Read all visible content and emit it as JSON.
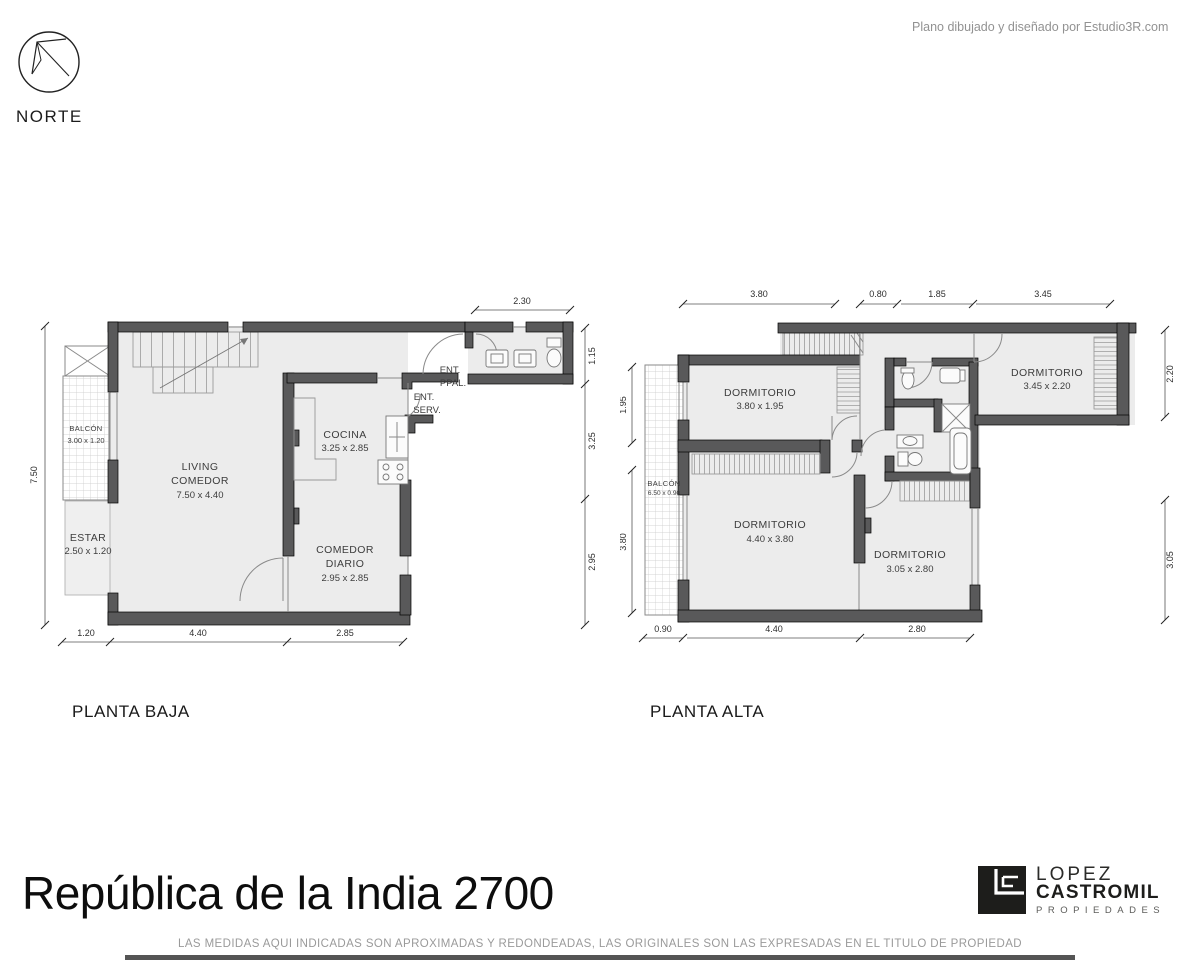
{
  "meta": {
    "credit": "Plano dibujado y diseñado por Estudio3R.com",
    "north_label": "NORTE",
    "title": "República de la India 2700",
    "disclaimer": "LAS MEDIDAS AQUI INDICADAS SON APROXIMADAS Y REDONDEADAS, LAS ORIGINALES SON LAS EXPRESADAS EN EL TITULO DE PROPIEDAD"
  },
  "branding": {
    "monogram": "LC",
    "line1": "LOPEZ",
    "line2": "CASTROMIL",
    "line3": "PROPIEDADES",
    "logo_color": "#1d1d1b"
  },
  "colors": {
    "wall": "#59595a",
    "floor": "#ececec",
    "credit_text": "#929292"
  },
  "planta_baja": {
    "label": "PLANTA BAJA",
    "rooms": {
      "balcon": {
        "name": "BALCÓN",
        "dims": "3.00 x 1.20"
      },
      "estar": {
        "name": "ESTAR",
        "dims": "2.50 x 1.20"
      },
      "living": {
        "name1": "LIVING",
        "name2": "COMEDOR",
        "dims": "7.50 x 4.40"
      },
      "cocina": {
        "name": "COCINA",
        "dims": "3.25 x 2.85"
      },
      "comedor_diario": {
        "name1": "COMEDOR",
        "name2": "DIARIO",
        "dims": "2.95 x 2.85"
      },
      "ent_ppal": {
        "line1": "ENT.",
        "line2": "PPAL."
      },
      "ent_serv": {
        "line1": "ENT.",
        "line2": "SERV."
      }
    },
    "dims": {
      "top": "2.30",
      "right1": "1.15",
      "right2": "3.25",
      "right3": "2.95",
      "left": "7.50",
      "bottom1": "1.20",
      "bottom2": "4.40",
      "bottom3": "2.85"
    }
  },
  "planta_alta": {
    "label": "PLANTA ALTA",
    "rooms": {
      "balcon": {
        "name": "BALCÓN",
        "dims": "6.50 x 0.90"
      },
      "dorm_norte": {
        "name": "DORMITORIO",
        "dims": "3.80 x 1.95"
      },
      "dorm_este": {
        "name": "DORMITORIO",
        "dims": "3.45 x 2.20"
      },
      "dorm_principal": {
        "name": "DORMITORIO",
        "dims": "4.40 x 3.80"
      },
      "dorm_sur": {
        "name": "DORMITORIO",
        "dims": "3.05 x 2.80"
      }
    },
    "dims": {
      "top1": "3.80",
      "top2": "0.80",
      "top3": "1.85",
      "top4": "3.45",
      "left1": "1.95",
      "left2": "3.80",
      "right1": "2.20",
      "right2": "3.05",
      "bottom1": "0.90",
      "bottom2": "4.40",
      "bottom3": "2.80"
    }
  }
}
